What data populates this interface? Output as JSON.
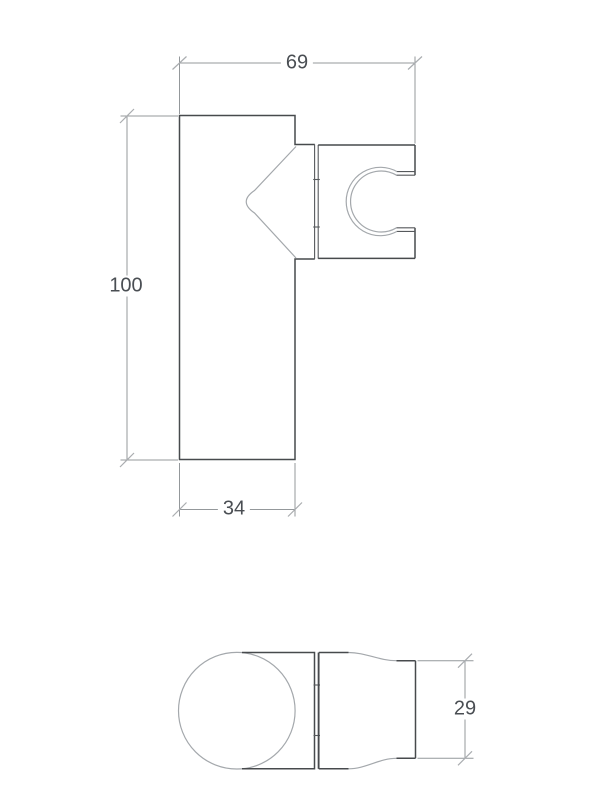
{
  "drawing": {
    "kind": "technical-dimension-drawing",
    "dims": {
      "overall_width": "69",
      "overall_height": "100",
      "body_width": "34",
      "bracket_depth": "29"
    },
    "colors": {
      "background": "#ffffff",
      "outline": "#474a4d",
      "thin_line": "#a4a8ac",
      "dimension_line": "#94989b",
      "text": "#4a4e53"
    }
  }
}
